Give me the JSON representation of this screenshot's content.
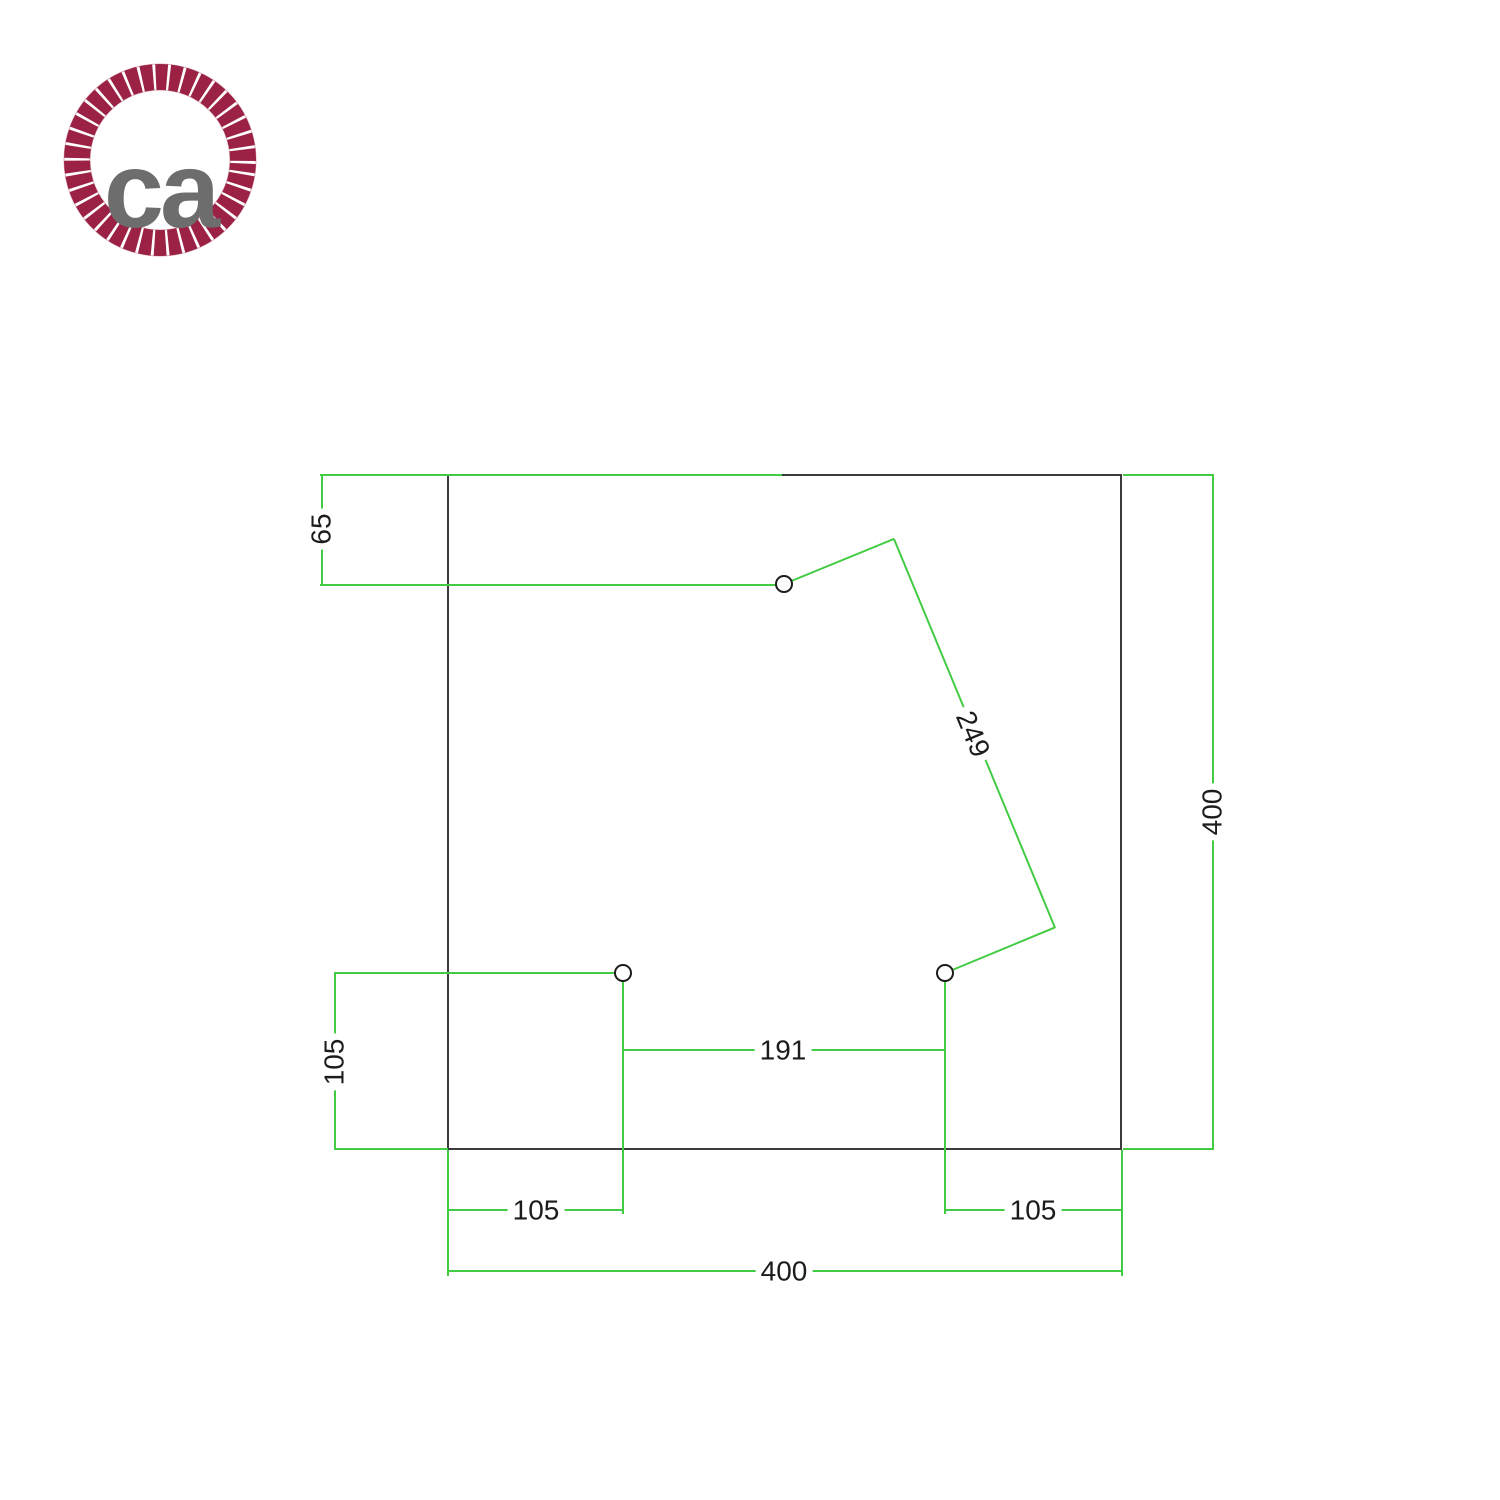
{
  "logo": {
    "text": "ca"
  },
  "labels": {
    "top_hole_offset": "65",
    "plate_height": "400",
    "diagonal_hole_spacing": "249",
    "left_hole_height_offset": "105",
    "bottom_holes_spacing": "191",
    "bottom_left_hole_offset": "105",
    "bottom_right_hole_offset": "105",
    "plate_width": "400"
  },
  "colors": {
    "dimension_green": "#44cb44",
    "plate_outline": "#3b3b3b",
    "text_ink": "#1c1c1c",
    "logo_ring": "#9b2244",
    "logo_text_gray": "#6d6d6d"
  }
}
